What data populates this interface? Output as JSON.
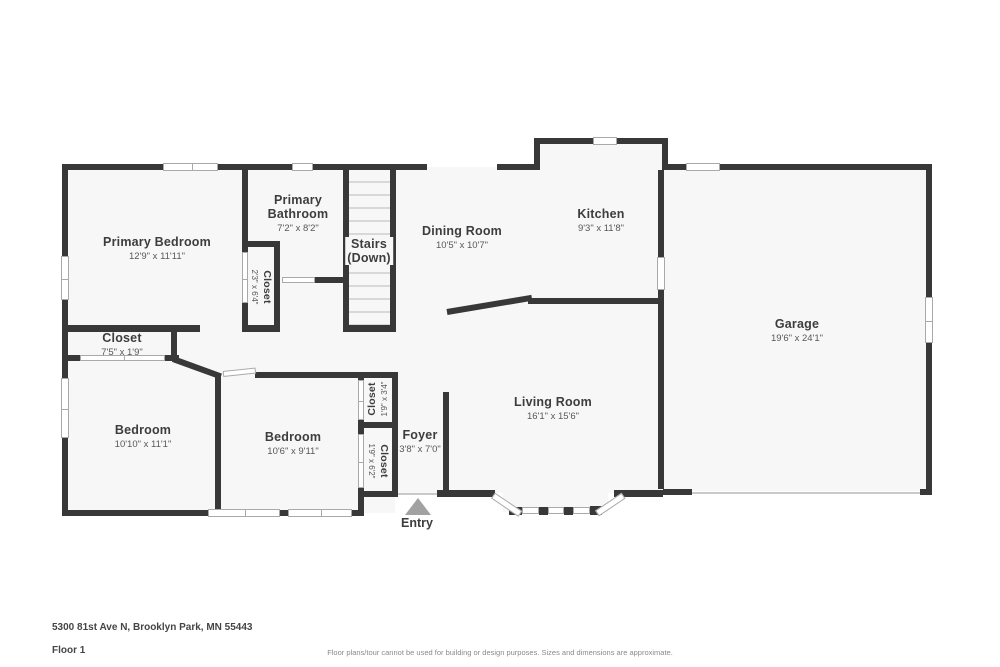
{
  "rooms": {
    "primary_bedroom": {
      "name": "Primary Bedroom",
      "dims": "12'9\" x 11'11\""
    },
    "primary_bathroom": {
      "name": "Primary Bathroom",
      "dims": "7'2\" x 8'2\""
    },
    "hall_closet": {
      "name": "Closet",
      "dims": "2'3\" x 6'4\""
    },
    "stairs": {
      "name": "Stairs",
      "sub": "(Down)"
    },
    "dining_room": {
      "name": "Dining Room",
      "dims": "10'5\" x 10'7\""
    },
    "kitchen": {
      "name": "Kitchen",
      "dims": "9'3\" x 11'8\""
    },
    "garage": {
      "name": "Garage",
      "dims": "19'6\" x 24'1\""
    },
    "top_closet": {
      "name": "Closet",
      "dims": "7'5\" x 1'9\""
    },
    "bedroom_left": {
      "name": "Bedroom",
      "dims": "10'10\" x 11'1\""
    },
    "bedroom_right": {
      "name": "Bedroom",
      "dims": "10'6\" x 9'11\""
    },
    "small_closet": {
      "name": "Closet",
      "dims": "1'9\" x 3'4\""
    },
    "foyer_closet": {
      "name": "Closet",
      "dims": "1'9\" x 6'2\""
    },
    "foyer": {
      "name": "Foyer",
      "dims": "3'8\" x 7'0\""
    },
    "living_room": {
      "name": "Living Room",
      "dims": "16'1\" x 15'6\""
    },
    "entry": {
      "name": "Entry"
    }
  },
  "footer": {
    "address": "5300 81st Ave N, Brooklyn Park, MN 55443",
    "floor_label": "Floor 1",
    "disclaimer": "Floor plans/tour cannot be used for building or design purposes. Sizes and dimensions are approximate."
  },
  "colors": {
    "wall": "#383838",
    "floor": "#f7f7f8",
    "window_line": "#a9a9a9",
    "entry_arrow": "#a2a2a2"
  }
}
